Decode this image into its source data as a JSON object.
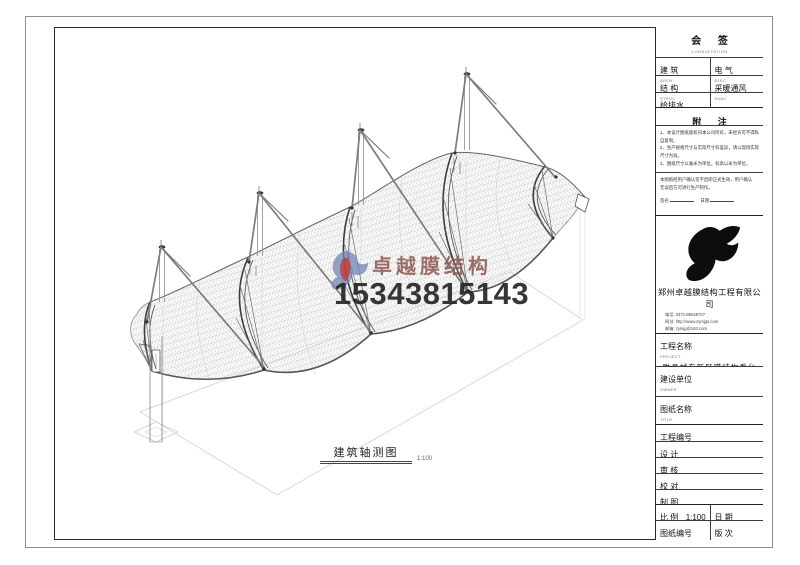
{
  "drawing": {
    "caption": "建筑轴测图",
    "caption_scale": "1:100"
  },
  "watermark": {
    "brand": "卓越膜结构",
    "phone": "15343815143"
  },
  "titleblock": {
    "consult": {
      "title": "会 签",
      "sub": "CONSULTATION",
      "cells": [
        {
          "label": "建 筑",
          "sub": "ARCH."
        },
        {
          "label": "电 气",
          "sub": "ELEC."
        },
        {
          "label": "结 构",
          "sub": "STRUC."
        },
        {
          "label": "采暖通风",
          "sub": "HVAC"
        },
        {
          "label": "给排水",
          "sub": "W.S.D."
        },
        {
          "label": "",
          "sub": ""
        }
      ]
    },
    "notes": {
      "title": "附 注",
      "sub": "DESCRIPTION",
      "lines": [
        "1、本设计图纸版权归本公司所有，未经许可不得私自复制。",
        "2、生产规格尺寸与实际尺寸有差异，请以现场实际尺寸为准。",
        "3、图纸尺寸以毫米为单位，标高以米为单位。"
      ]
    },
    "confirm": {
      "lines": [
        "本图纸经用户确认签字后即正式生效，用户确认",
        "无误后方可进行生产制作。"
      ],
      "sign_label": "签名:",
      "date_label": "日期:"
    },
    "company": {
      "name": "郑州卓越膜结构工程有限公司",
      "tel": "电话: 0371-86548707",
      "web": "网址: http://www.zymjgs.com",
      "mail": "邮箱: zymjg@163.com"
    },
    "fields": {
      "project": {
        "label": "工程名称",
        "sub": "PROJECT",
        "value": "睢县城东新区膜结构看台"
      },
      "owner": {
        "label": "建设单位",
        "sub": "OWNER",
        "value": ""
      },
      "dwg_title": {
        "label": "图纸名称",
        "sub": "TITLE",
        "value": "建筑轴测图"
      },
      "contract": {
        "label": "工程编号",
        "sub": "CONTRACT No.",
        "value": ""
      },
      "roles": [
        {
          "label": "设 计",
          "sub": "DESIGNER"
        },
        {
          "label": "审 核",
          "sub": "CHECKER"
        },
        {
          "label": "校 对",
          "sub": "PROOFREAD"
        },
        {
          "label": "制 图",
          "sub": "DRAWN"
        }
      ],
      "scale": {
        "label": "比 例",
        "sub": "SCALE",
        "value": "1:100"
      },
      "date": {
        "label": "日 期",
        "sub": "DATE",
        "value": "2014.08.30"
      },
      "dwg_no": {
        "label": "图纸编号",
        "sub": "DRAWING No.",
        "value": "S02"
      },
      "version": {
        "label": "版 次",
        "sub": "VERSION No.",
        "value": "VER.01"
      }
    }
  },
  "colors": {
    "frame_dark": "#2a2a2a",
    "brand_text": "#8d5750",
    "phone_text": "#262626",
    "logo_blue": "#7384b6",
    "logo_red": "#c0392f"
  }
}
